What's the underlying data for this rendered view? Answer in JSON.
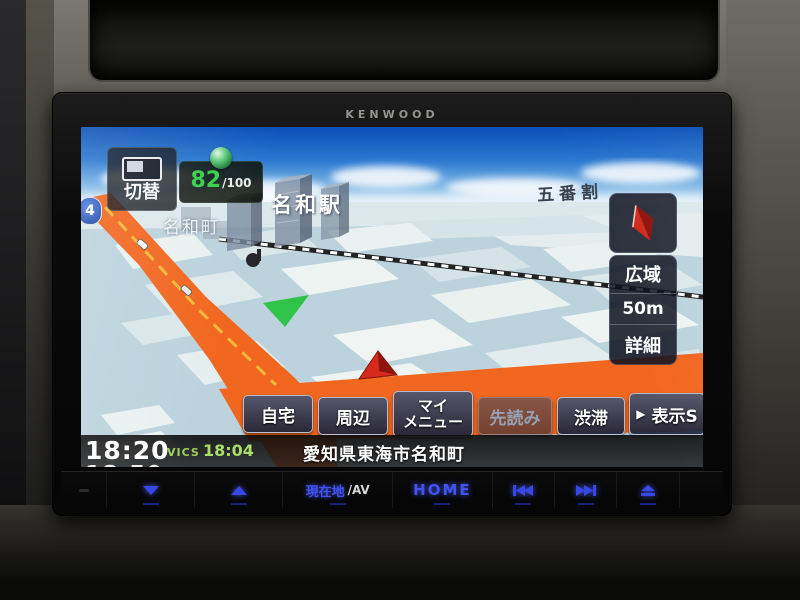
{
  "brand": "KENWOOD",
  "screen": {
    "top_left": {
      "switch_label": "切替",
      "eco_score": "82",
      "eco_denominator": "/100"
    },
    "map": {
      "town_label": "名和町",
      "station_label": "名和駅",
      "district_label": "五番割",
      "route_shield": "4"
    },
    "right_panel": {
      "wide_label": "広域",
      "scale_label": "50m",
      "detail_label": "詳細"
    },
    "menu_buttons": {
      "home": "自宅",
      "nearby": "周辺",
      "my_menu_line1": "マイ",
      "my_menu_line2": "メニュー",
      "lookahead": "先読み",
      "traffic": "渋滞",
      "display_arrow": "▶",
      "display": "表示S"
    },
    "status_bar": {
      "clock": "18:20",
      "clock_secondary": "18:50",
      "vics_label": "VICS",
      "vics_time": "18:04",
      "address": "愛知県東海市名和町"
    }
  },
  "hardware_bar": {
    "current_location_label": "現在地",
    "av_label": "/AV",
    "home_label": "HOME"
  },
  "colors": {
    "hardware_accent_blue": "#3847e8",
    "route_orange": "#f2671f",
    "eco_green": "#35d04a",
    "vics_green": "#a6d85c",
    "sky_blue": "#1560c8"
  }
}
